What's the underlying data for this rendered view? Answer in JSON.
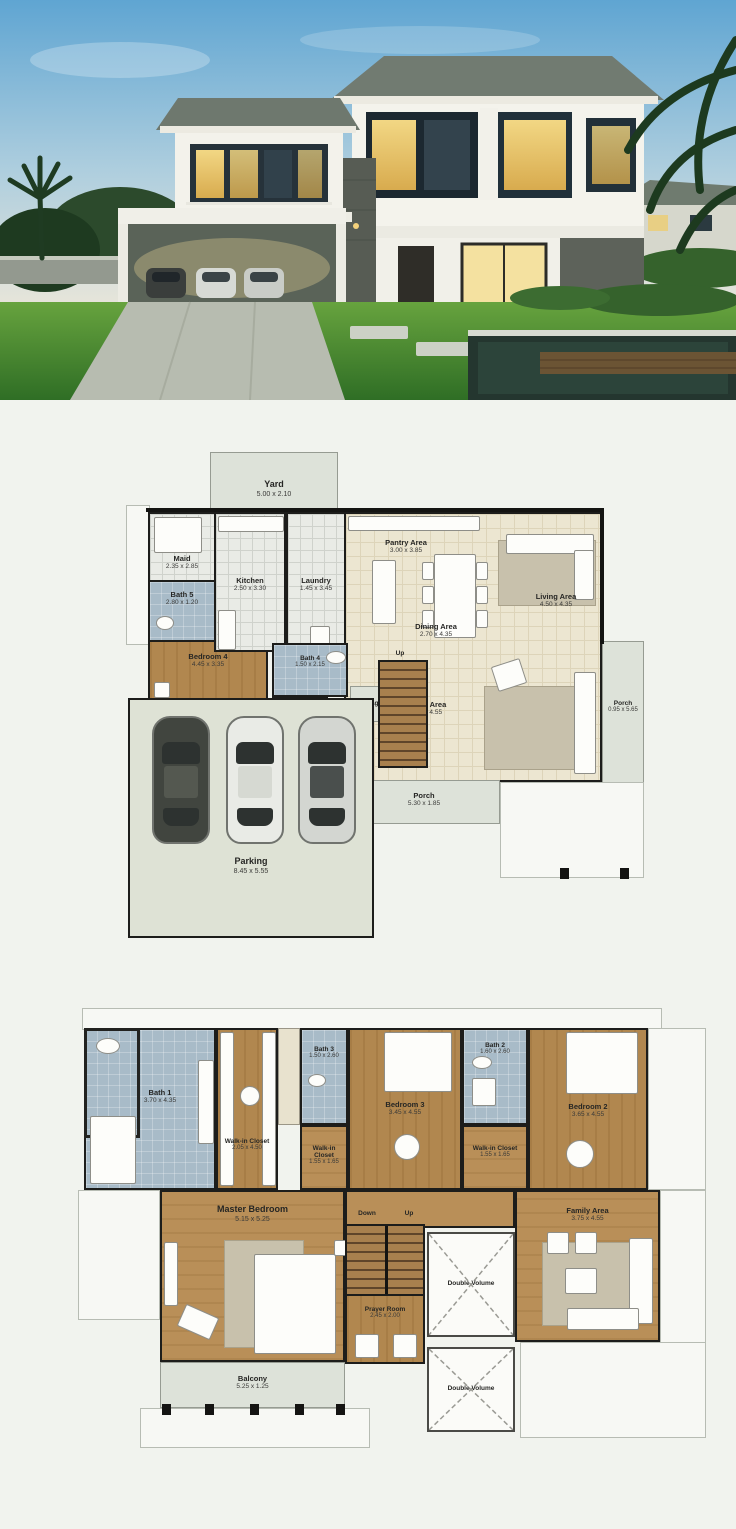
{
  "image_type": "architectural house plan collage",
  "colors": {
    "page_bg": "#f1f3ee",
    "wood_floor": "#b1874f",
    "bath_floor": "#a8bbc8",
    "living_floor": "#ece6d1",
    "deck": "#dde2d9",
    "wall": "#1d1d1b",
    "sky": "#6fb0d6",
    "lawn": "#4f9335",
    "lit_window": "#e9c564"
  },
  "photo": {
    "subject": "modern-two-storey-house-dusk"
  },
  "plan1": {
    "rooms": [
      {
        "label": "Yard",
        "dims": "5.00 x 2.10"
      },
      {
        "label": "Maid",
        "dims": "2.35 x 2.85"
      },
      {
        "label": "Kitchen",
        "dims": "2.50 x 3.30"
      },
      {
        "label": "Laundry",
        "dims": "1.45 x 3.45"
      },
      {
        "label": "Pantry Area",
        "dims": "3.00 x 3.85"
      },
      {
        "label": "Living Area",
        "dims": "4.50 x 4.35"
      },
      {
        "label": "Dining Area",
        "dims": "2.70 x 4.35"
      },
      {
        "label": "Bath 5",
        "dims": "2.80 x 1.20"
      },
      {
        "label": "Bedroom 4",
        "dims": "4.45 x 3.35"
      },
      {
        "label": "Bath 4",
        "dims": "1.50 x 2.15"
      },
      {
        "label": "Storage",
        "dims": ""
      },
      {
        "label": "Up",
        "dims": ""
      },
      {
        "label": "Living Area",
        "dims": "6.45 x 4.55"
      },
      {
        "label": "Porch",
        "dims": "0.95 x 5.65"
      },
      {
        "label": "Porch",
        "dims": "5.30 x 1.85"
      },
      {
        "label": "Parking",
        "dims": "8.45 x 5.55"
      }
    ]
  },
  "plan2": {
    "rooms": [
      {
        "label": "Bath 1",
        "dims": "3.70 x 4.35"
      },
      {
        "label": "Walk-in Closet",
        "dims": "2.05 x 4.50"
      },
      {
        "label": "Bath 3",
        "dims": "1.50 x 2.60"
      },
      {
        "label": "Bedroom 3",
        "dims": "3.45 x 4.55"
      },
      {
        "label": "Bath 2",
        "dims": "1.60 x 2.60"
      },
      {
        "label": "Bedroom 2",
        "dims": "3.65 x 4.55"
      },
      {
        "label": "Walk-in Closet",
        "dims": "1.55 x 1.65"
      },
      {
        "label": "Walk-in Closet",
        "dims": "1.55 x 1.65"
      },
      {
        "label": "Master Bedroom",
        "dims": "5.15 x 5.25"
      },
      {
        "label": "Down",
        "dims": ""
      },
      {
        "label": "Up",
        "dims": ""
      },
      {
        "label": "Prayer Room",
        "dims": "2.45 x 2.00"
      },
      {
        "label": "Family Area",
        "dims": "3.75 x 4.55"
      },
      {
        "label": "Double Volume",
        "dims": ""
      },
      {
        "label": "Double Volume",
        "dims": ""
      },
      {
        "label": "Balcony",
        "dims": "5.25 x 1.25"
      }
    ]
  }
}
